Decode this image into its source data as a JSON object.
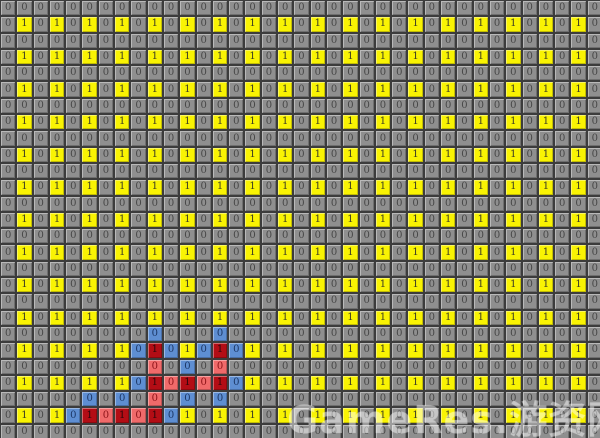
{
  "board": {
    "cols": 37,
    "rows": 27,
    "cell_px": 16.3,
    "rows_map": [
      ".....................................",
      ".Y.Y.Y.Y.Y.Y.Y.Y.Y.Y.Y.Y.Y.Y.Y.Y.Y.Y.",
      ".....................................",
      ".Y.Y.Y.Y.Y.Y.Y.Y.Y.Y.Y.Y.Y.Y.Y.Y.Y.Y.",
      ".....................................",
      ".Y.Y.Y.Y.Y.Y.Y.Y.Y.Y.Y.Y.Y.Y.Y.Y.Y.Y.",
      ".....................................",
      ".Y.Y.Y.Y.Y.Y.Y.Y.Y.Y.Y.Y.Y.Y.Y.Y.Y.Y.",
      ".....................................",
      ".Y.Y.Y.Y.Y.Y.Y.Y.Y.Y.Y.Y.Y.Y.Y.Y.Y.Y.",
      ".....................................",
      ".Y.Y.Y.Y.Y.Y.Y.Y.Y.Y.Y.Y.Y.Y.Y.Y.Y.Y.",
      ".....................................",
      ".Y.Y.Y.Y.Y.Y.Y.Y.Y.Y.Y.Y.Y.Y.Y.Y.Y.Y.",
      ".....................................",
      ".Y.Y.Y.Y.Y.Y.Y.Y.Y.Y.Y.Y.Y.Y.Y.Y.Y.Y.",
      ".....................................",
      ".Y.Y.Y.Y.Y.Y.Y.Y.Y.Y.Y.Y.Y.Y.Y.Y.Y.Y.",
      ".....................................",
      ".Y.Y.Y.Y.Y.Y.Y.Y.Y.Y.Y.Y.Y.Y.Y.Y.Y.Y.",
      ".........B...B.......................",
      ".Y.Y.Y.YBRBYBRBY.Y.Y.Y.Y.Y.Y.Y.Y.Y.Y.",
      ".........r.B.r.......................",
      ".Y.Y.Y.YBRrRrRBY.Y.Y.Y.Y.Y.Y.Y.Y.Y.Y.",
      ".....B.B.r.B.B.......................",
      ".Y.YBRrRrRBY.Y.Y.Y.Y.Y.Y.Y.Y.Y.Y.Y.Y.",
      "....................................."
    ],
    "legend": {
      ".": {
        "digit": "0",
        "type": "gray-zero",
        "bg": "#8f8f8f",
        "fg": "#474747"
      },
      "Y": {
        "digit": "1",
        "type": "yellow-one",
        "bg": "#f9f303",
        "fg": "#3d3d24"
      },
      "B": {
        "digit": "0",
        "type": "blue-zero",
        "bg": "#5e8ed2",
        "fg": "#1c3766"
      },
      "R": {
        "digit": "1",
        "type": "red-dark-one",
        "bg": "#b30d15",
        "fg": "#2e070b"
      },
      "r": {
        "digit": "0",
        "type": "red-light-zero",
        "bg": "#f06a6a",
        "fg": "#8c1318"
      }
    },
    "colors": {
      "grid_border": "#3c3c3c",
      "background": "#8f8f8f",
      "accent_yellow": "#f9f303",
      "accent_blue": "#5e8ed2",
      "accent_red_dark": "#b30d15",
      "accent_red_light": "#f06a6a"
    }
  },
  "watermark": {
    "text": "GameRes.游资网"
  }
}
